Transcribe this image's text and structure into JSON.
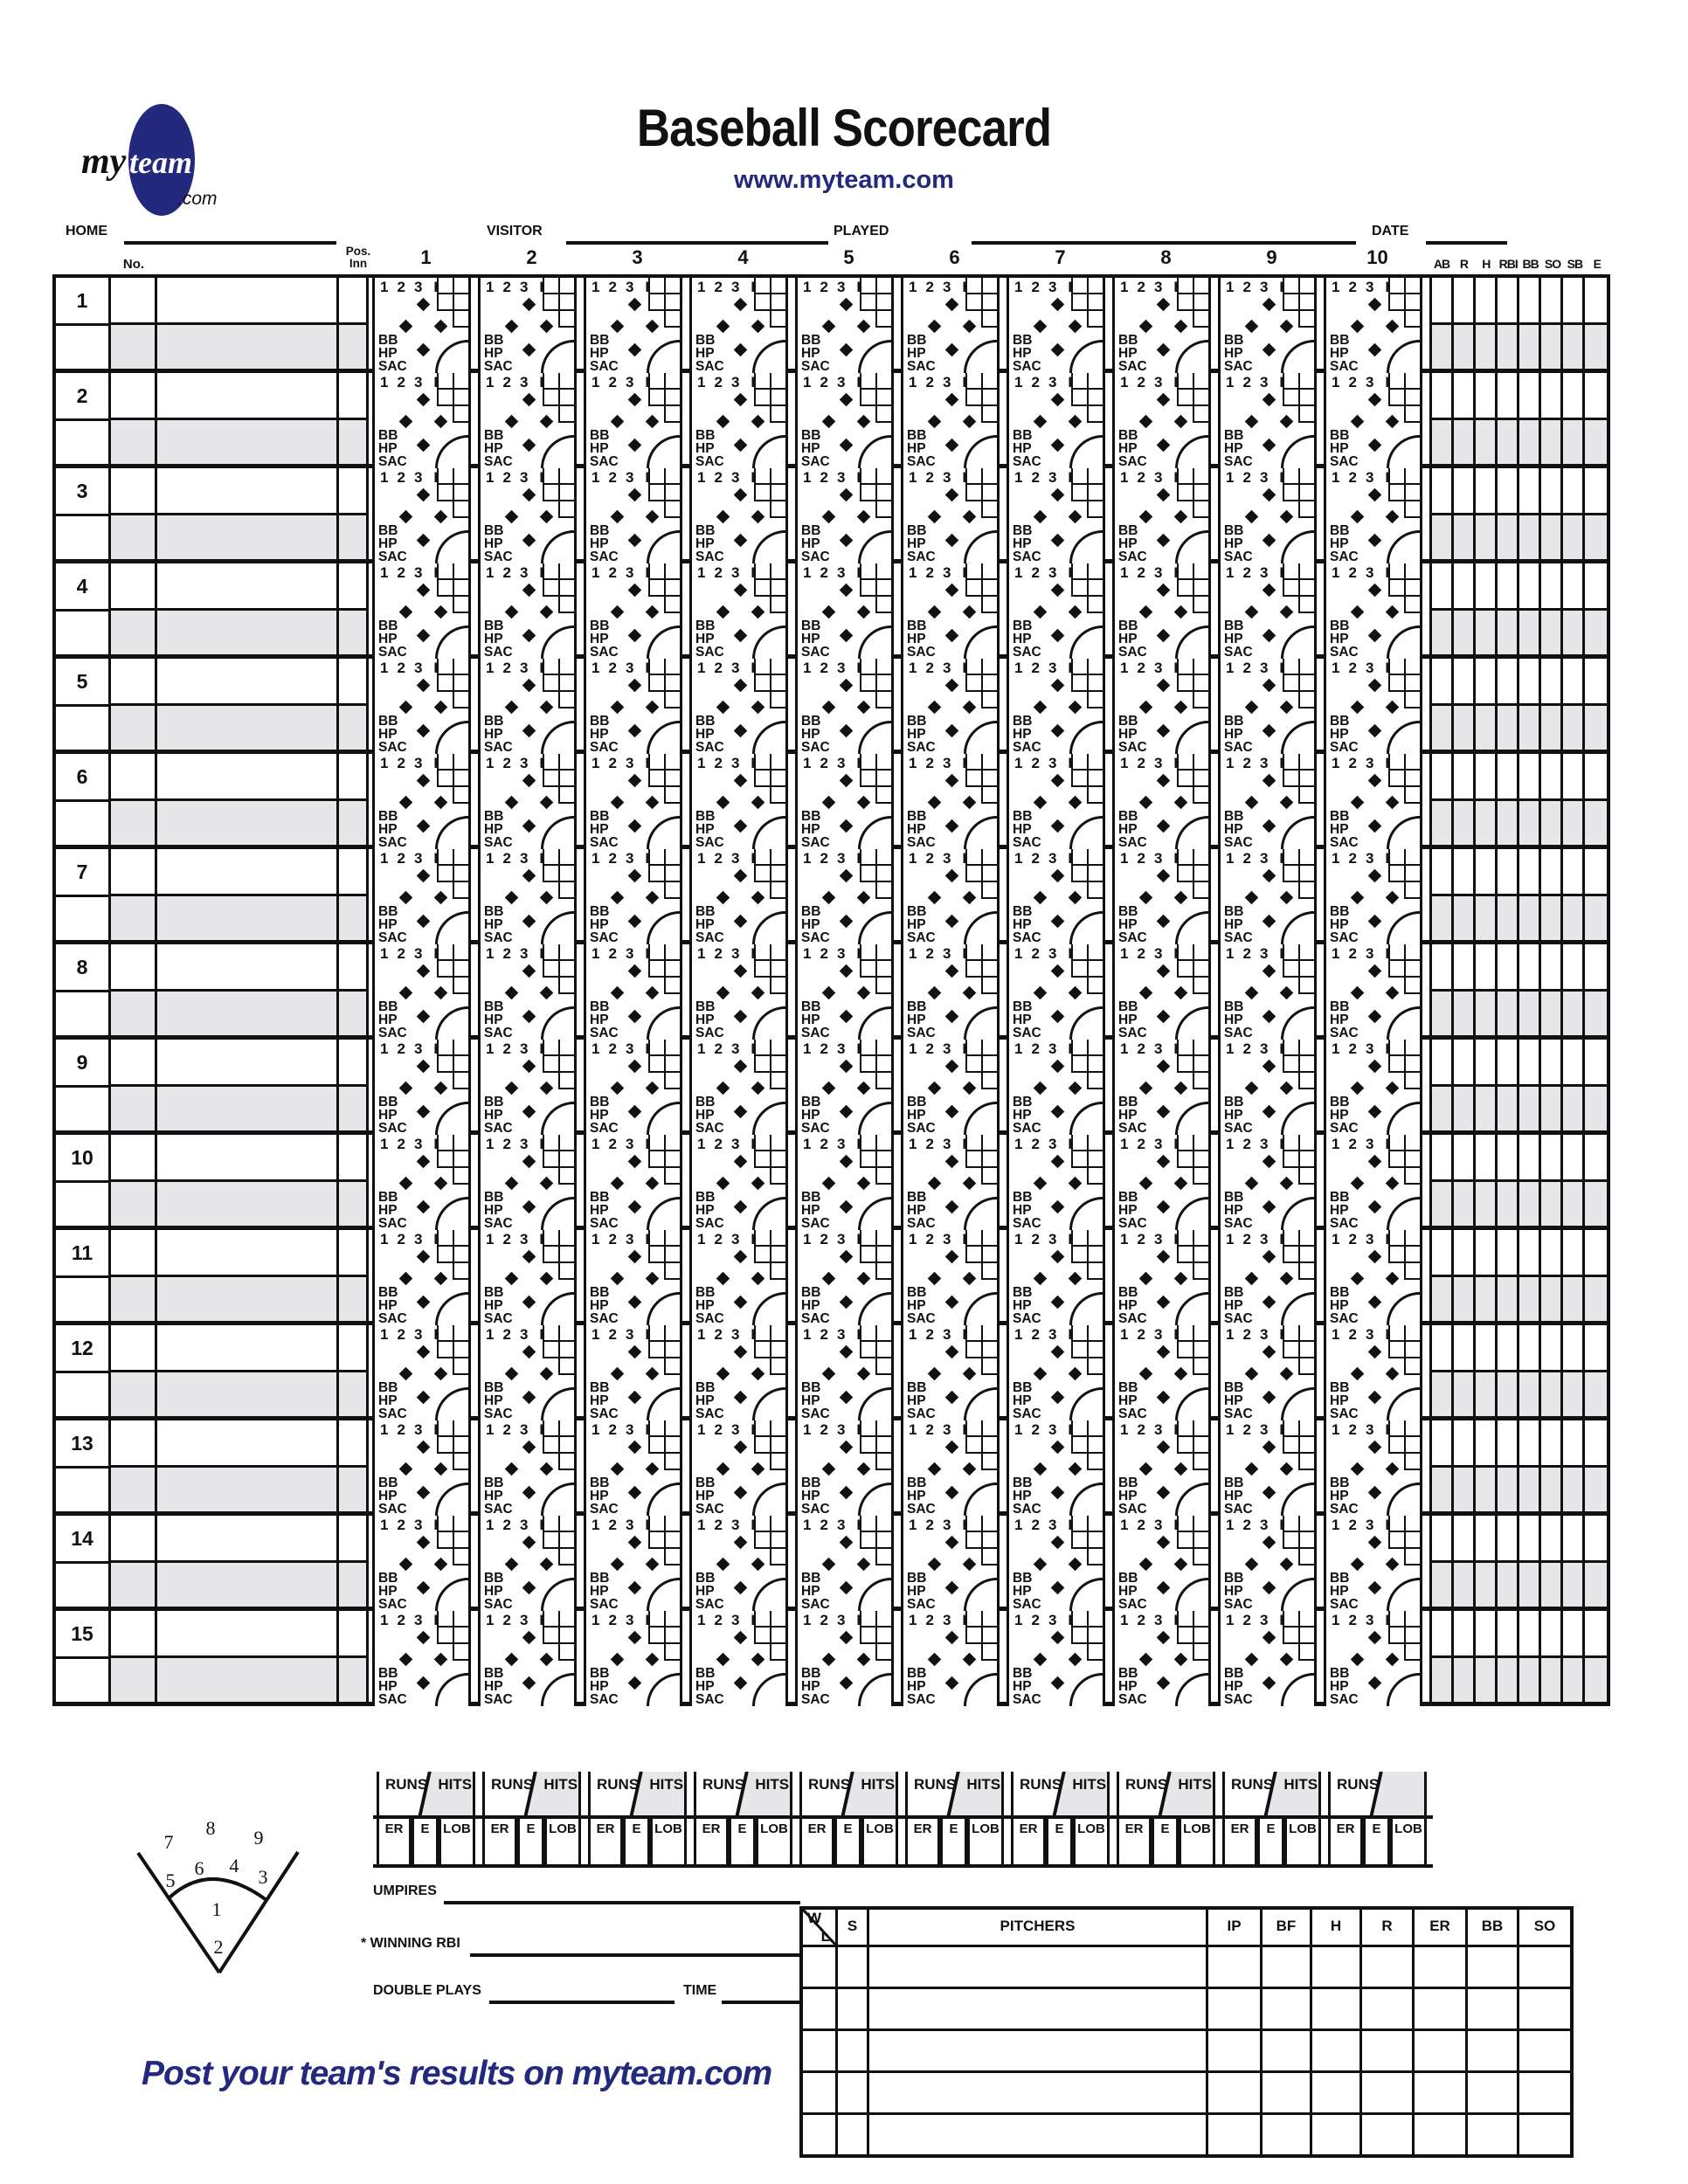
{
  "logo": {
    "part1": "my",
    "part2": "team",
    "part3": ".com"
  },
  "masthead": {
    "title": "Baseball Scorecard",
    "website": "www.myteam.com"
  },
  "info_line": {
    "home": "HOME",
    "visitor": "VISITOR",
    "played": "PLAYED",
    "date": "DATE"
  },
  "grid": {
    "no_header": "No.",
    "pos_header": "Pos.",
    "inn_header": "Inn",
    "inning_numbers": [
      "1",
      "2",
      "3",
      "4",
      "5",
      "6",
      "7",
      "8",
      "9",
      "10"
    ],
    "stat_headers": [
      "AB",
      "R",
      "H",
      "RBI",
      "BB",
      "SO",
      "SB",
      "E"
    ],
    "player_rows": [
      "1",
      "2",
      "3",
      "4",
      "5",
      "6",
      "7",
      "8",
      "9",
      "10",
      "11",
      "12",
      "13",
      "14",
      "15"
    ],
    "cell": {
      "pitch_labels": [
        "1",
        "2",
        "3",
        "HR"
      ],
      "reach_labels": [
        "BB",
        "HP",
        "SAC"
      ]
    },
    "totals": {
      "runs": "RUNS",
      "hits": "HITS",
      "er_cells": [
        "ER",
        "E",
        "LOB"
      ]
    }
  },
  "diagram": {
    "position_numbers": [
      "1",
      "2",
      "3",
      "4",
      "5",
      "6",
      "7",
      "8",
      "9"
    ]
  },
  "footer": {
    "umpires": "UMPIRES",
    "winning_rbi": "* WINNING RBI",
    "double_plays": "DOUBLE PLAYS",
    "time": "TIME"
  },
  "pitchers": {
    "win": "W",
    "loss": "L",
    "save": "S",
    "title": "PITCHERS",
    "stat_headers": [
      "IP",
      "BF",
      "H",
      "R",
      "ER",
      "BB",
      "SO"
    ],
    "row_count": 5
  },
  "tagline": "Post your team's results on myteam.com",
  "colors": {
    "navy": "#23297d",
    "gray": "#e7e7e9",
    "line": "#111111"
  }
}
